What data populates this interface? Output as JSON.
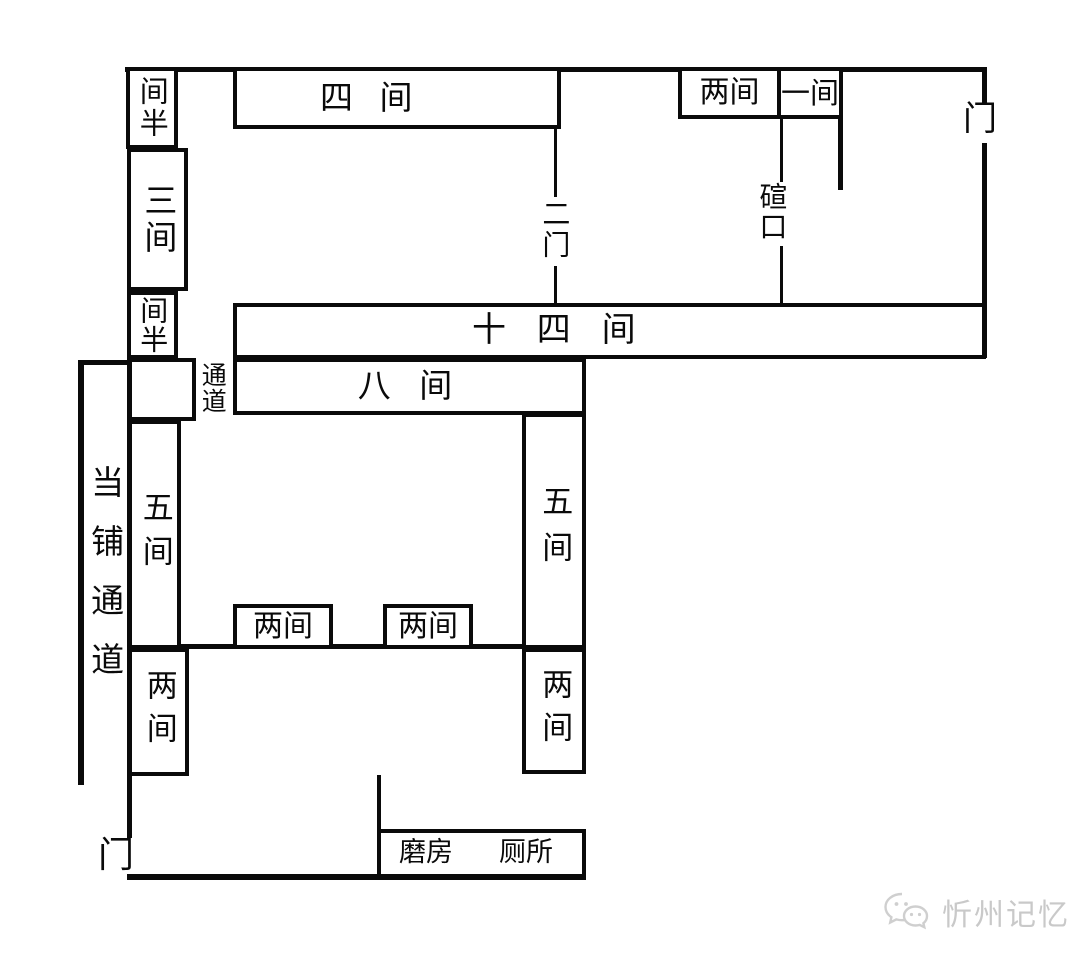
{
  "diagram": {
    "type": "floor-plan",
    "colors": {
      "background": "#ffffff",
      "line": "#0a0a0a",
      "watermark": "#c9c9c9"
    },
    "rooms": {
      "jianban_top": "间半",
      "sijian": "四 间",
      "liangjian_top": "两间",
      "yijian": "一间",
      "sanjian": "三间",
      "jianban_mid": "间半",
      "shisijian": "十 四 间",
      "bajian": "八 间",
      "wujian_left": "五间",
      "wujian_right": "五间",
      "liangjian_court1": "两间",
      "liangjian_court2": "两间",
      "liangjian_lower_left": "两间",
      "liangjian_lower_right": "两间",
      "mofang": "磨房",
      "cesuo": "厕所"
    },
    "annotations": {
      "men_top": "门",
      "men_bottom": "门",
      "ermen": "二门",
      "xuankou": "碹口",
      "tongdao": "通道",
      "dangpu_tongdao": "当铺通道"
    },
    "watermark": {
      "text": "忻州记忆"
    }
  }
}
